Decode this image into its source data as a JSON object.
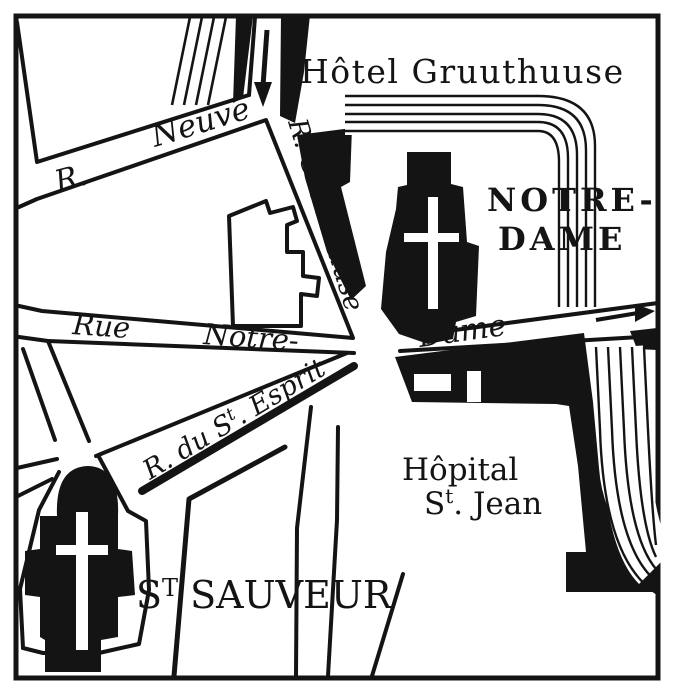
{
  "map": {
    "paper_color": "#ffffff",
    "ink_color": "#141414",
    "places": {
      "hotel_gruuthuuse": "Hôtel Gruuthuuse",
      "notre_dame_line1": "NOTRE-",
      "notre_dame_line2": "DAME",
      "hopital_line1": "Hôpital",
      "hopital_line2_cap": "S",
      "hopital_line2_sup": "t",
      "hopital_line2_rest": ". Jean",
      "st_sauveur_cap": "S",
      "st_sauveur_sup": "T",
      "st_sauveur_rest": " SAUVEUR"
    },
    "streets": {
      "rue_neuve_prefix": "R.",
      "rue_neuve_name": "Neuve",
      "rue_gruuthuuse": "R. Gruuthuuse",
      "rue_notre_word1": "Rue",
      "rue_notre_word2": "Notre-",
      "rue_notre_word3": "Dame",
      "esprit_prefix": "R. du S",
      "esprit_sup": "t",
      "esprit_rest": ". Esprit"
    },
    "icons": {
      "down_arrow": "south-bound street arrow",
      "east_arrow": "east-bound street arrow",
      "church_cross": "church cross"
    }
  }
}
